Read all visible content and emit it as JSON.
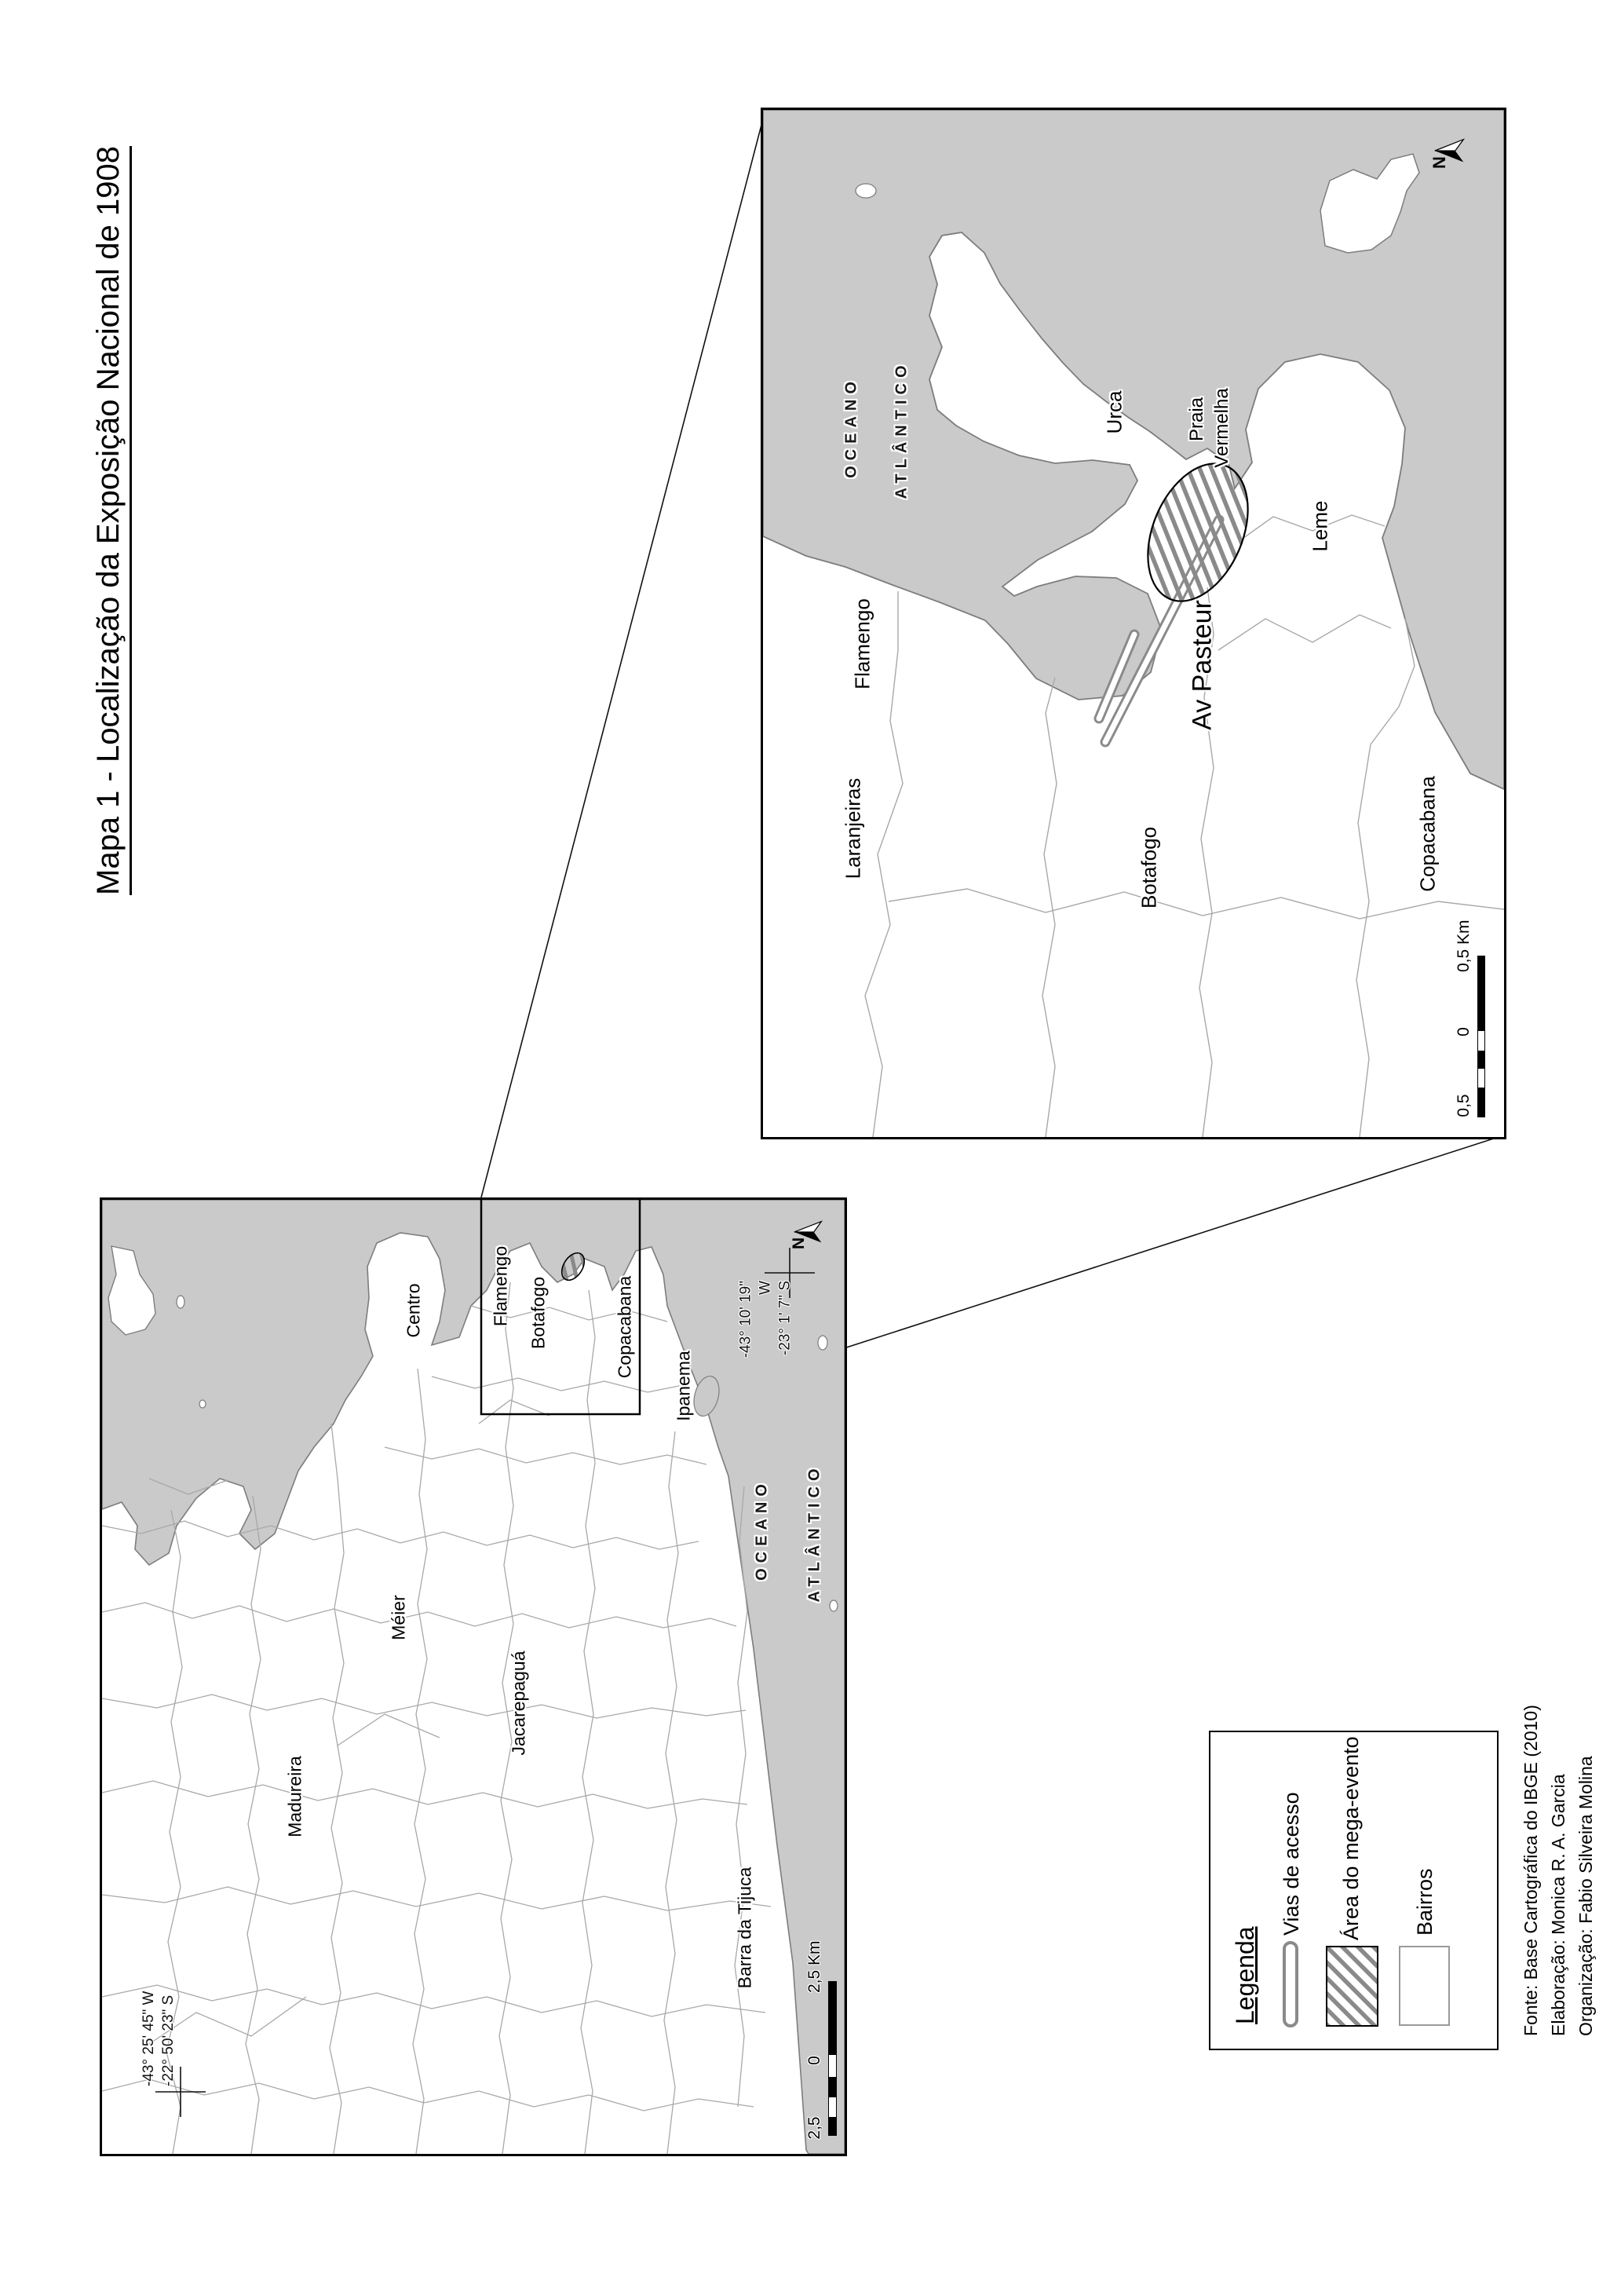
{
  "title": "Mapa 1 - Localização da Exposição Nacional de 1908",
  "inset_map": {
    "ocean_line1": "OCEANO",
    "ocean_line2": "ATLÂNTICO",
    "labels": {
      "flamengo": "Flamengo",
      "laranjeiras": "Laranjeiras",
      "botafogo": "Botafogo",
      "urca": "Urca",
      "praia_line1": "Praia",
      "praia_line2": "Vermelha",
      "leme": "Leme",
      "copacabana": "Copacabana",
      "av_pasteur": "Av Pasteur"
    },
    "north_label": "N",
    "scale": {
      "left": "0,5",
      "mid": "0",
      "right": "0,5 Km"
    }
  },
  "overview_map": {
    "ocean_line1": "OCEANO",
    "ocean_line2": "ATLÂNTICO",
    "labels": {
      "centro": "Centro",
      "flamengo": "Flamengo",
      "botafogo": "Botafogo",
      "copacabana": "Copacabana",
      "ipanema": "Ipanema",
      "meier": "Méier",
      "jacarepagua": "Jacarepaguá",
      "madureira": "Madureira",
      "barra": "Barra da Tijuca"
    },
    "north_label": "N",
    "coords_ne": {
      "line1": "-43° 10' 19\" W",
      "line2": "-23° 1' 7\" S"
    },
    "coords_sw": {
      "line1": "-43° 25' 45\" W",
      "line2": "-22° 50' 23\" S"
    },
    "scale": {
      "left": "2,5",
      "mid": "0",
      "right": "2,5 Km"
    }
  },
  "legend": {
    "title": "Legenda",
    "items": [
      {
        "label": "Vias de acesso"
      },
      {
        "label": "Área do mega-evento"
      },
      {
        "label": "Bairros"
      }
    ]
  },
  "credits": {
    "line1": "Fonte: Base Cartográfica do IBGE (2010)",
    "line2": "Elaboração: Monica R. A. Garcia",
    "line3": "Organização: Fabio Silveira Molina"
  },
  "colors": {
    "ocean": "#cacaca",
    "land": "#ffffff",
    "coast": "#7d7d7d",
    "boundary": "#a8a8a8",
    "hatch": "#8a8a8a",
    "frame": "#000000"
  }
}
